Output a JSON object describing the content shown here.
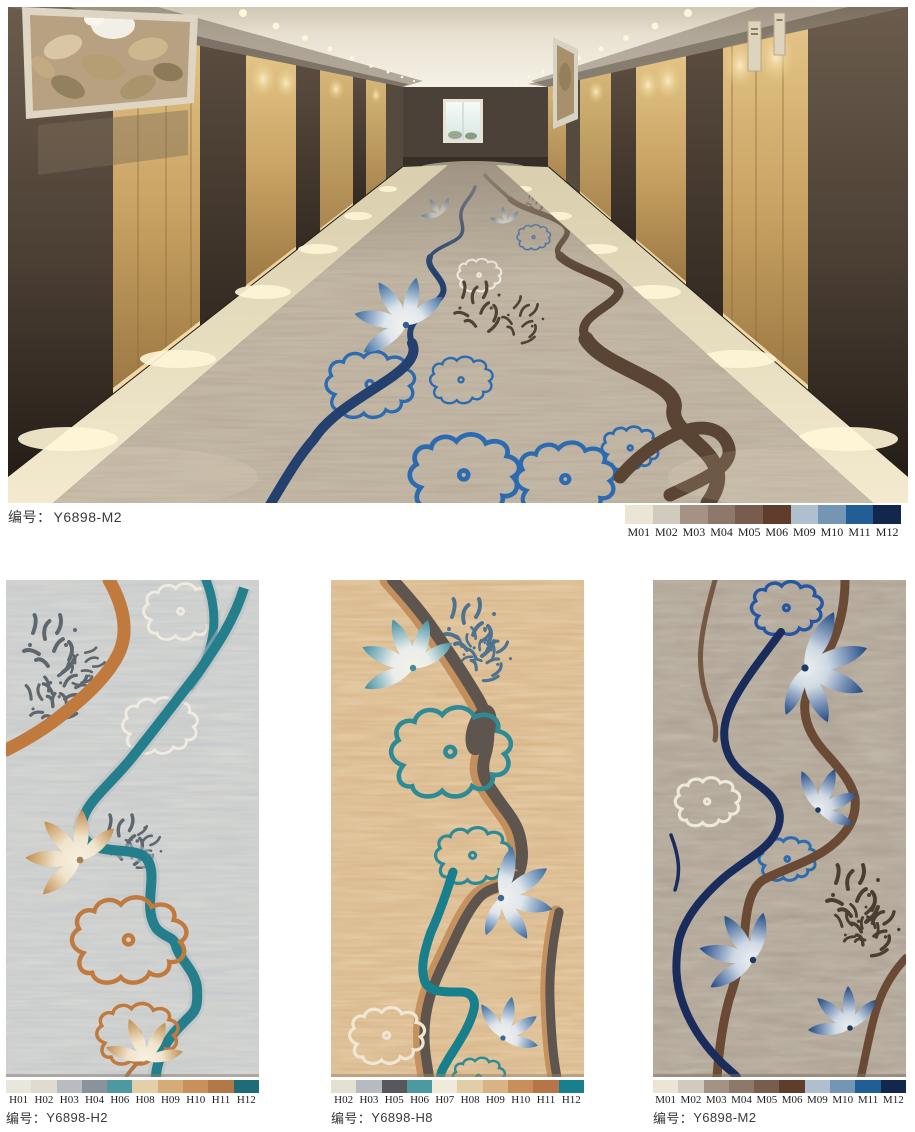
{
  "hero": {
    "caption_label": "编号：",
    "code": "Y6898-M2",
    "palette": [
      {
        "code": "M01",
        "color": "#EBE5D6"
      },
      {
        "code": "M02",
        "color": "#D2CABC"
      },
      {
        "code": "M03",
        "color": "#A49385"
      },
      {
        "code": "M04",
        "color": "#8E7869"
      },
      {
        "code": "M05",
        "color": "#785D4E"
      },
      {
        "code": "M06",
        "color": "#603D2A"
      },
      {
        "code": "M09",
        "color": "#B0BFCE"
      },
      {
        "code": "M10",
        "color": "#7496B4"
      },
      {
        "code": "M11",
        "color": "#215E95"
      },
      {
        "code": "M12",
        "color": "#13264B"
      }
    ]
  },
  "products": [
    {
      "caption_label": "编号：",
      "code": "Y6898-H2",
      "palette": [
        {
          "code": "H01",
          "color": "#E9E6DB"
        },
        {
          "code": "H02",
          "color": "#DFDBCE"
        },
        {
          "code": "H03",
          "color": "#B8BCC1"
        },
        {
          "code": "H04",
          "color": "#8A939B"
        },
        {
          "code": "H06",
          "color": "#4E98A1"
        },
        {
          "code": "H08",
          "color": "#E3D0A9"
        },
        {
          "code": "H09",
          "color": "#D5AC77"
        },
        {
          "code": "H10",
          "color": "#C9905C"
        },
        {
          "code": "H11",
          "color": "#B47747"
        },
        {
          "code": "H12",
          "color": "#1D6C78"
        }
      ]
    },
    {
      "caption_label": "编号：",
      "code": "Y6898-H8",
      "palette": [
        {
          "code": "H02",
          "color": "#E4E0D2"
        },
        {
          "code": "H03",
          "color": "#B7BBC1"
        },
        {
          "code": "H05",
          "color": "#56585C"
        },
        {
          "code": "H06",
          "color": "#4D99A2"
        },
        {
          "code": "H07",
          "color": "#F0EADB"
        },
        {
          "code": "H08",
          "color": "#E2CEA6"
        },
        {
          "code": "H09",
          "color": "#DAB384"
        },
        {
          "code": "H10",
          "color": "#C88F5B"
        },
        {
          "code": "H11",
          "color": "#B57546"
        },
        {
          "code": "H12",
          "color": "#18808C"
        }
      ]
    },
    {
      "caption_label": "编号：",
      "code": "Y6898-M2",
      "palette": [
        {
          "code": "M01",
          "color": "#EBE5D6"
        },
        {
          "code": "M02",
          "color": "#D2CABC"
        },
        {
          "code": "M03",
          "color": "#A49385"
        },
        {
          "code": "M04",
          "color": "#8E7869"
        },
        {
          "code": "M05",
          "color": "#785D4E"
        },
        {
          "code": "M06",
          "color": "#603D2A"
        },
        {
          "code": "M09",
          "color": "#B0BFCE"
        },
        {
          "code": "M10",
          "color": "#7496B4"
        },
        {
          "code": "M11",
          "color": "#215E95"
        },
        {
          "code": "M12",
          "color": "#13264B"
        }
      ]
    }
  ]
}
